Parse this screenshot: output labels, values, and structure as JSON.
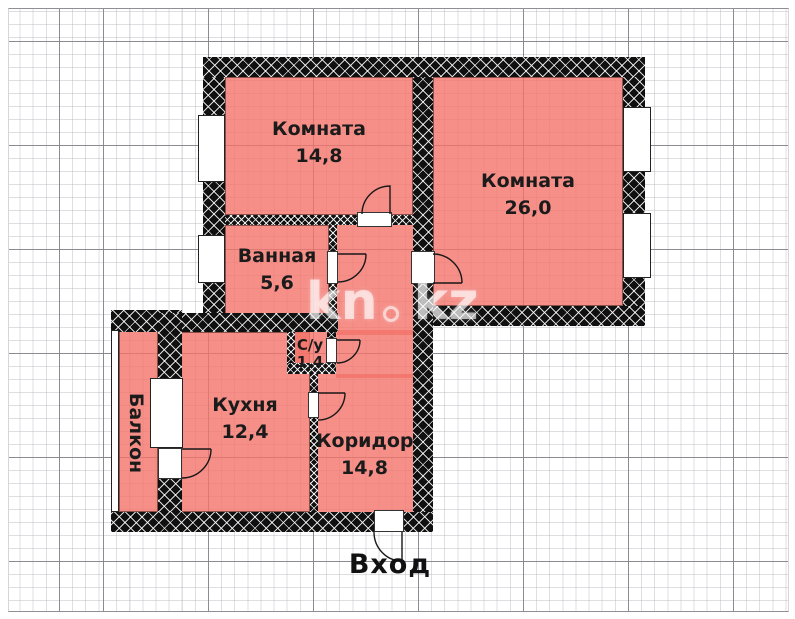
{
  "plan_title": "apartment-floor-plan",
  "rooms": {
    "room1": {
      "name": "Комната",
      "area": "14,8"
    },
    "room2": {
      "name": "Комната",
      "area": "26,0"
    },
    "bathroom": {
      "name": "Ванная",
      "area": "5,6"
    },
    "wc": {
      "name": "С/у",
      "area": "1,4"
    },
    "kitchen": {
      "name": "Кухня",
      "area": "12,4"
    },
    "corridor": {
      "name": "Коридор",
      "area": "14,8"
    },
    "balcony": {
      "name": "Балкон"
    }
  },
  "entrance_label": "Вход",
  "watermark": {
    "prefix": "kn",
    "suffix": "kz"
  },
  "colors": {
    "room_fill": "rgba(242,115,106,0.8)",
    "wall": "#101010",
    "label": "#1b1b1b",
    "watermark": "rgba(255,255,255,0.62)",
    "grid_major": "#82828c",
    "grid_minor": "#c8c8d2"
  }
}
